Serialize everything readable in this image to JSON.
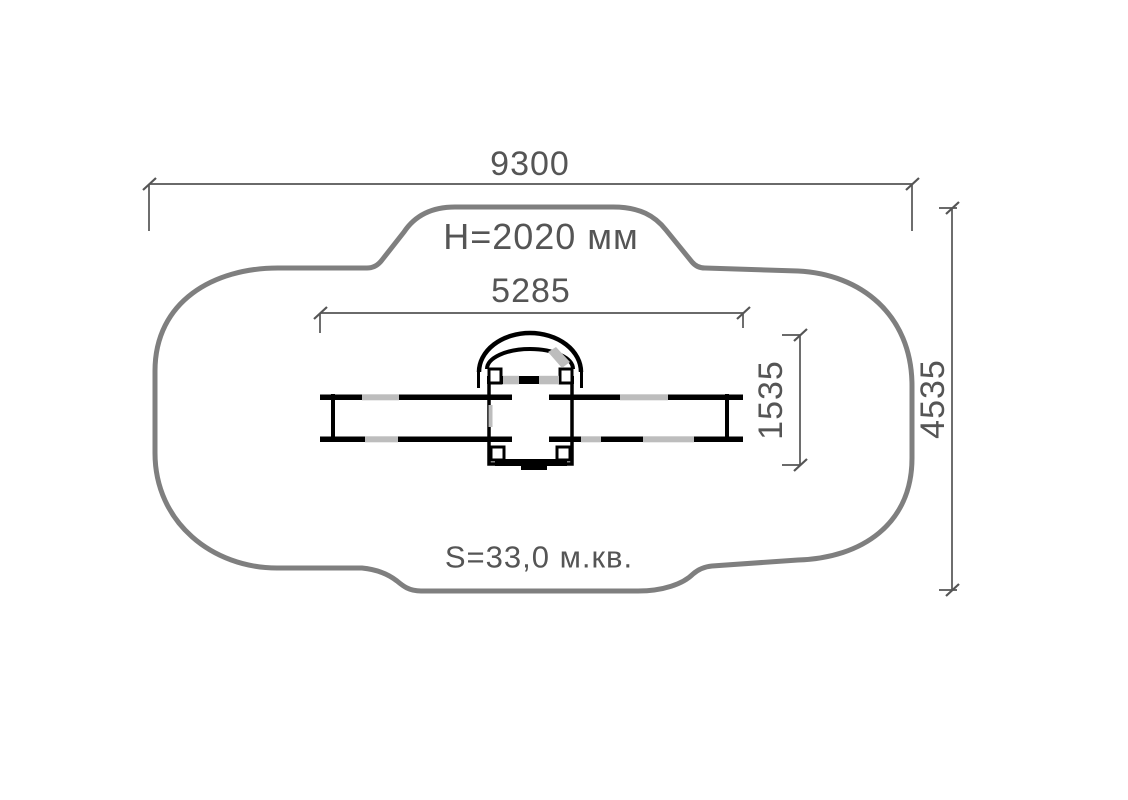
{
  "drawing": {
    "type": "site-plan-technical-drawing",
    "labels": {
      "overall_width": "9300",
      "overall_height": "4535",
      "inner_width": "5285",
      "inner_depth": "1535",
      "height_note": "H=2020 мм",
      "area_note": "S=33,0 м.кв."
    },
    "colors": {
      "outline": "#7f7f7f",
      "dimension": "#555555",
      "equipment": "#000000",
      "watermark": "#bdbdbd"
    }
  }
}
